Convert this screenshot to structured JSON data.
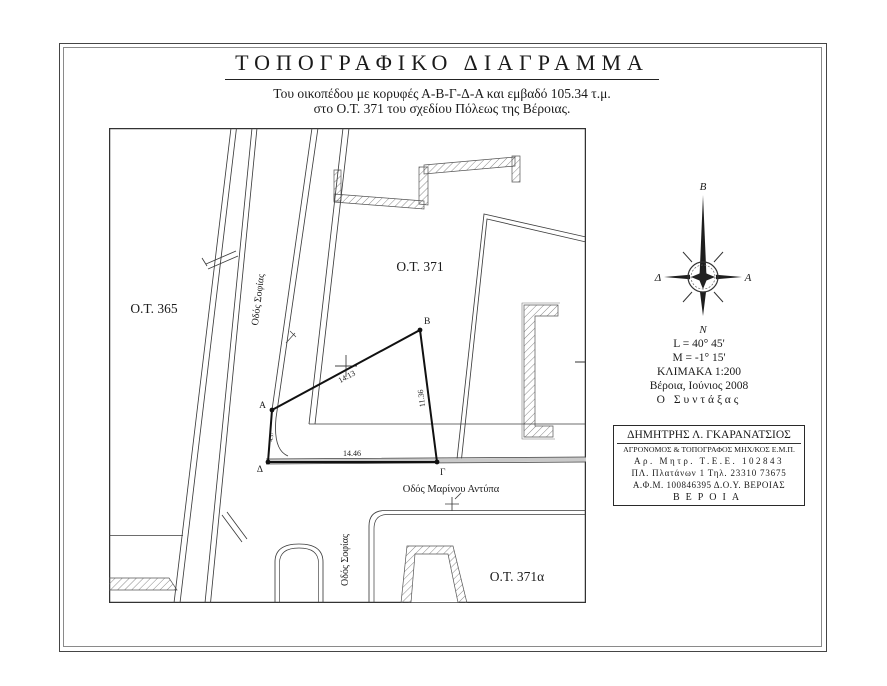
{
  "header": {
    "title": "ΤΟΠΟΓΡΑΦΙΚΟ ΔΙΑΓΡΑΜΜΑ",
    "subtitle1": "Του οικοπέδου με κορυφές Α-Β-Γ-Δ-Α και εμβαδό 105.34 τ.μ.",
    "subtitle2": "στο Ο.Τ. 371 του σχεδίου Πόλεως της Βέροιας."
  },
  "map": {
    "block_left": "Ο.Τ. 365",
    "block_center": "Ο.Τ. 371",
    "block_bottom": "Ο.Τ. 371α",
    "street_sofias_upper": "Οδός Σοφίας",
    "street_sofias_lower": "Οδός Σοφίας",
    "street_antypa": "Οδός Μαρίνου Αντύπα",
    "vertex_a": "A",
    "vertex_b": "B",
    "vertex_g": "Γ",
    "vertex_d": "Δ",
    "len_ab": "14.13",
    "len_bg": "11.36",
    "len_dg": "14.46",
    "len_ad": "4.37",
    "y_ticks": [
      "-25950",
      "-25970",
      "-25990"
    ],
    "x_ticks": [
      "-22295",
      "-22275",
      "-22255"
    ]
  },
  "compass": {
    "north": "Β",
    "south": "Ν",
    "east": "Α",
    "west": "Δ"
  },
  "info": {
    "latitude": "L = 40° 45'",
    "meridian": "M = -1° 15'",
    "scale": "ΚΛΙΜΑΚΑ 1:200",
    "place_date": "Βέροια, Ιούνιος 2008",
    "author_label": "Ο Συντάξας"
  },
  "stamp": {
    "name": "ΔΗΜΗΤΡΗΣ Λ. ΓΚΑΡΑΝΑΤΣΙΟΣ",
    "profession": "ΑΓΡΟΝΟΜΟΣ & ΤΟΠΟΓΡΑΦΟΣ ΜΗΧ/ΚΟΣ Ε.Μ.Π.",
    "registry": "Αρ. Μητρ. Τ.Ε.Ε. 102843",
    "address": "ΠΛ. Πλατάνων 1 Τηλ. 23310 73675",
    "tax": "Α.Φ.Μ. 100846395 Δ.Ο.Υ. ΒΕΡΟΙΑΣ",
    "city": "ΒΕΡΟΙΑ"
  },
  "colors": {
    "ink": "#1a1a1a",
    "line": "#3d3d3d",
    "accent_gray": "#c9c9c9"
  }
}
